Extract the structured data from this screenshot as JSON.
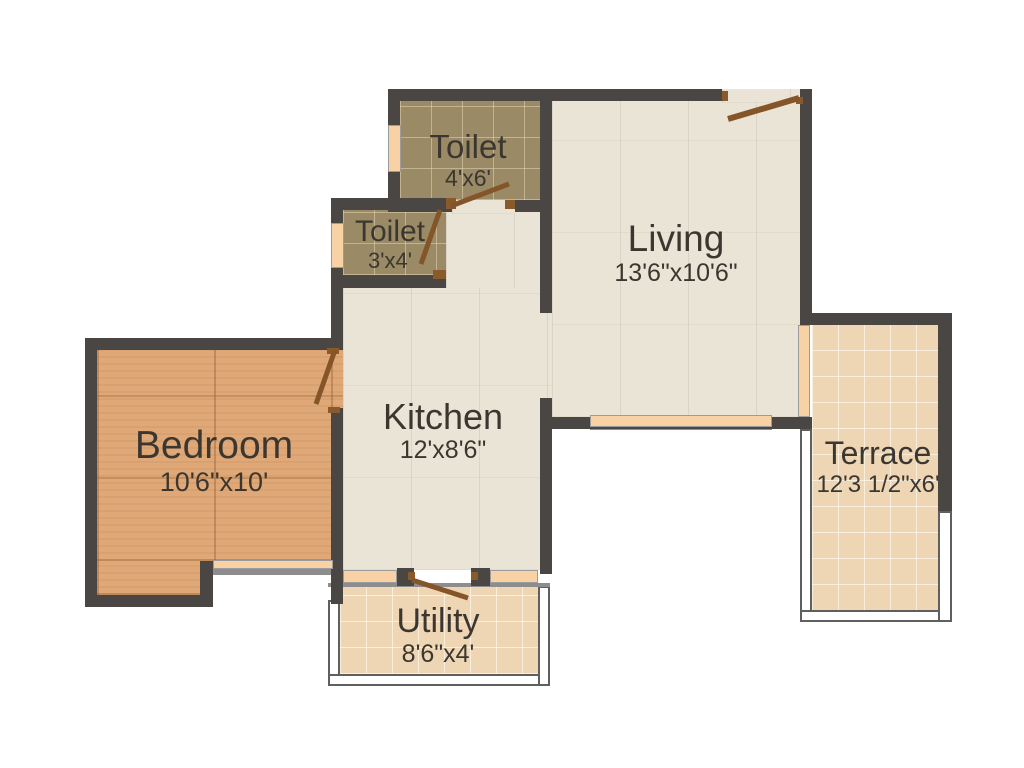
{
  "floorplan": {
    "colors": {
      "background": "#ffffff",
      "wall": "#494643",
      "door": "#85552a",
      "window": "#f8d2a5",
      "floor_living_kitchen": "#eae4d6",
      "floor_toilet": "#9a8a66",
      "floor_bedroom": "#e0a876",
      "floor_terrace_utility": "#eed5b4",
      "text": "#3b3730"
    },
    "rooms": {
      "toilet_top": {
        "name": "Toilet",
        "dims": "4'x6'"
      },
      "toilet_small": {
        "name": "Toilet",
        "dims": "3'x4'"
      },
      "living": {
        "name": "Living",
        "dims": "13'6\"x10'6\""
      },
      "kitchen": {
        "name": "Kitchen",
        "dims": "12'x8'6\""
      },
      "bedroom": {
        "name": "Bedroom",
        "dims": "10'6\"x10'"
      },
      "terrace": {
        "name": "Terrace",
        "dims": "12'3 1/2\"x6'"
      },
      "utility": {
        "name": "Utility",
        "dims": "8'6\"x4'"
      }
    }
  }
}
